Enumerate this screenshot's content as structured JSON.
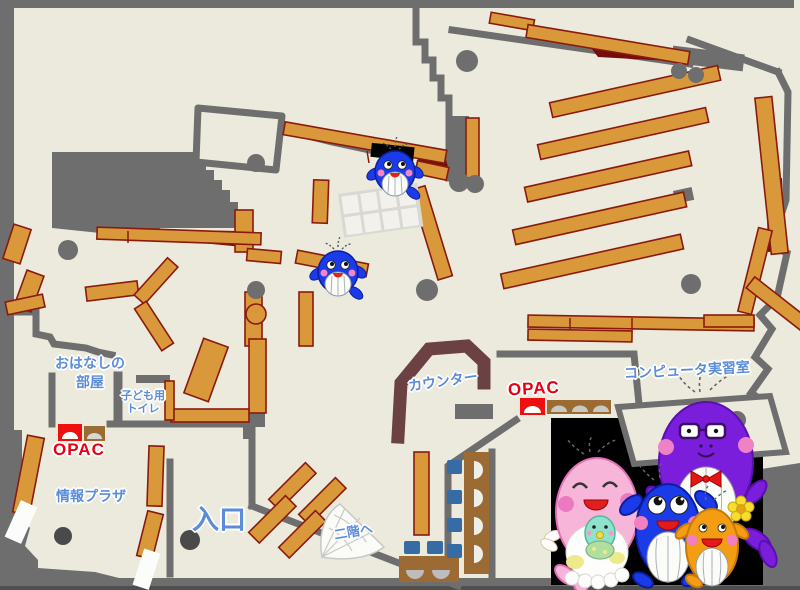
{
  "page": {
    "title": "Library first-floor map"
  },
  "labels": {
    "storytelling_room": {
      "line1": "おはなしの",
      "line2": "部屋"
    },
    "kids_toilet": {
      "line1": "子ども用",
      "line2": "トイレ"
    },
    "opac_left": "OPAC",
    "info_plaza": "情報プラザ",
    "entrance": "入口",
    "to_second_floor": "二階へ",
    "counter": "カウンター",
    "opac_right": "OPAC",
    "computer_room": "コンピュータ実習室"
  },
  "colors": {
    "floor": "#ECEADC",
    "wall_gray": "#6E6E6E",
    "wall_dark": "#4A4A4A",
    "shelf_fill": "#D9993B",
    "shelf_border": "#8B1A0E",
    "maroon_area": "#750D0D",
    "counter_brown": "#6B4144",
    "desk_brown": "#9C6B33",
    "chair_blue": "#366CA3",
    "label_blue": "#5B8CD9",
    "label_red": "#E60012",
    "mascot_panel": "#000000",
    "whale_blue": "#1B3BE8",
    "whale_pink": "#F8B5DA",
    "whale_purple": "#7A1EDC",
    "whale_orange": "#F49C12",
    "whale_baby_teal": "#8FE3CC"
  },
  "mascots": {
    "on_map": [
      "blue-whale-mascot",
      "blue-whale-mascot"
    ],
    "family_panel": [
      "pink-whale-with-baby",
      "blue-whale",
      "purple-whale-with-glasses",
      "orange-whale-with-flower"
    ]
  }
}
